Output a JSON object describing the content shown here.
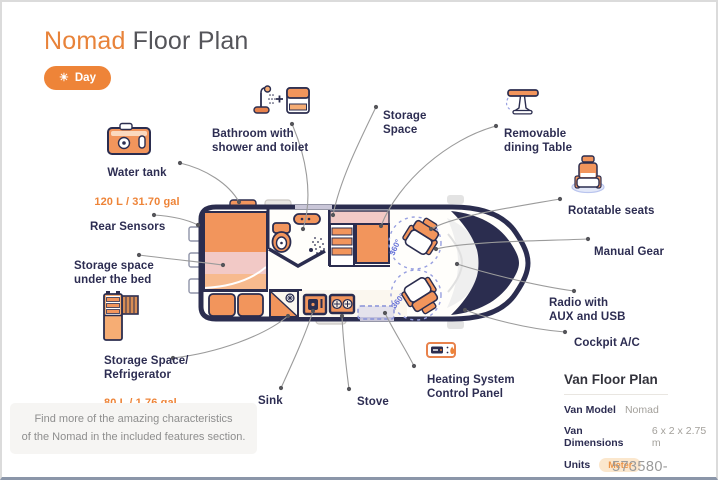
{
  "title": {
    "brand": "Nomad",
    "rest": "Floor Plan"
  },
  "toggle": {
    "icon": "☀",
    "label": "Day"
  },
  "callouts": {
    "water_tank": {
      "label": "Water tank",
      "value": "120 L / 31.70 gal"
    },
    "bathroom": {
      "label": "Bathroom with\nshower and toilet"
    },
    "storage_space": {
      "label": "Storage\nSpace"
    },
    "removable_table": {
      "label": "Removable\ndining Table"
    },
    "rear_sensors": {
      "label": "Rear Sensors"
    },
    "rotatable_seats": {
      "label": "Rotatable seats"
    },
    "storage_under_bed": {
      "label": "Storage space\nunder the bed"
    },
    "manual_gear": {
      "label": "Manual Gear"
    },
    "radio": {
      "label": "Radio with\nAUX and USB"
    },
    "fridge": {
      "label": "Storage Space/\nRefrigerator",
      "value": "80 L / 1.76 gal"
    },
    "cockpit_ac": {
      "label": "Cockpit A/C"
    },
    "sink": {
      "label": "Sink"
    },
    "stove": {
      "label": "Stove"
    },
    "heating": {
      "label": "Heating System\nControl Panel"
    }
  },
  "van": {
    "seat_rotation": "360°"
  },
  "note": "Find more of the amazing characteristics\nof the Nomad in the included features section.",
  "panel": {
    "title": "Van Floor Plan",
    "rows": [
      {
        "label": "Van Model",
        "value": "Nomad"
      },
      {
        "label": "Van Dimensions",
        "value": "6 x 2 x 2.75 m"
      },
      {
        "label": "Units",
        "value": "Meter"
      }
    ]
  },
  "watermark": "573580-21189770",
  "colors": {
    "accent": "#EE8438",
    "navy": "#2B2D4F",
    "pink": "#F2C9C6",
    "badge_bg": "#FBE7CD"
  }
}
